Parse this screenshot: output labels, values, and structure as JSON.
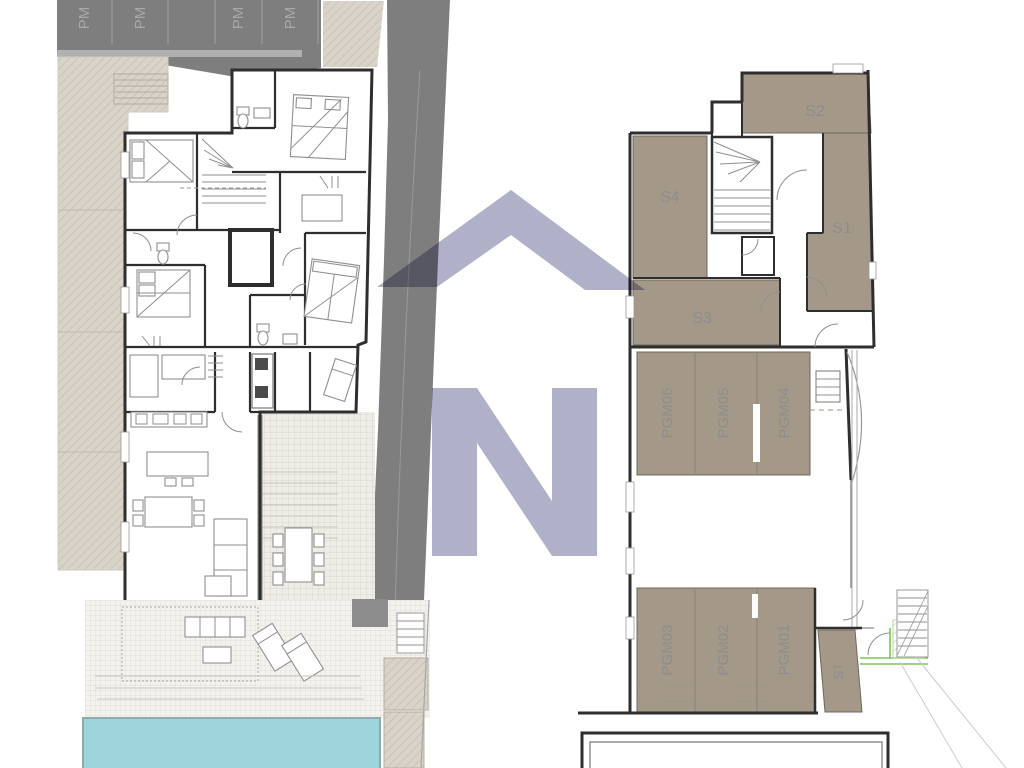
{
  "watermark": {
    "letter": "N"
  },
  "left_plan": {
    "parking_stalls": [
      {
        "label": "PM"
      },
      {
        "label": "PM"
      },
      {
        "label": "PM"
      },
      {
        "label": "PM"
      }
    ]
  },
  "right_plan": {
    "rooms": [
      {
        "label": "S4"
      },
      {
        "label": "S2"
      },
      {
        "label": "S1"
      },
      {
        "label": "S3"
      }
    ],
    "garage_upper": [
      {
        "label": "PGM06"
      },
      {
        "label": "PGM05"
      },
      {
        "label": "PGM04"
      }
    ],
    "garage_lower": [
      {
        "label": "PGM03"
      },
      {
        "label": "PGM02"
      },
      {
        "label": "PGM01"
      }
    ],
    "storage": {
      "label": "ST"
    }
  },
  "colors": {
    "road": "#7e7e7e",
    "room_fill": "#a49888",
    "room_border": "#6f675c",
    "label": "#8d8d8d",
    "pm_label": "#a8a8a8",
    "wall": "#2e2e2e",
    "pool": "#9fd4dc",
    "green": "#7dc353",
    "watermark": "#a9a9c5"
  }
}
